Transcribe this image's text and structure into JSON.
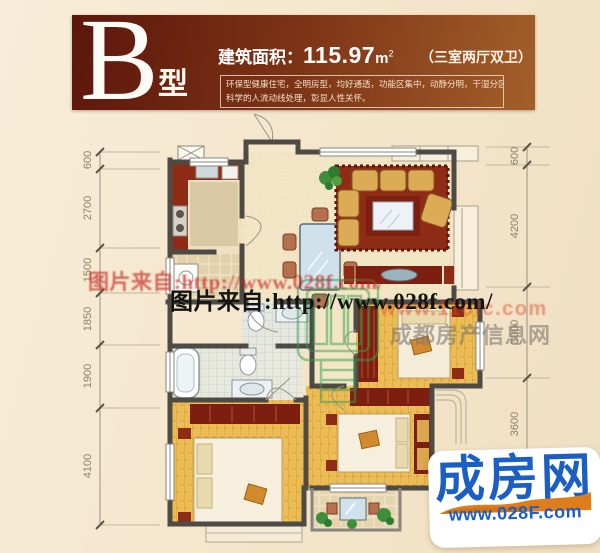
{
  "page": {
    "background": "#f4e6cf"
  },
  "header": {
    "type_letter": "B",
    "type_suffix": "型",
    "area_label": "建筑面积：",
    "area_value": "115.97",
    "area_unit": "m",
    "area_sup": "2",
    "layout_label": "（三室两厅双卫）",
    "desc_line1": "环保型健康住宅，全明房型，均好通透，功能区集中，动静分明，干湿分区，",
    "desc_line2": "科学的人流动线处理，彰显人性关怀。",
    "colors": {
      "gradient_left": "#5c160b",
      "gradient_right": "#a35f2a"
    }
  },
  "floor_plan": {
    "dims_left": [
      "600",
      "2700",
      "1500",
      "1850",
      "1900",
      "4100"
    ],
    "dims_right": [
      "600",
      "4200",
      "3000",
      "3600"
    ],
    "colors": {
      "wall": "#4e4a44",
      "wood_floor": "#edbd55",
      "rug": "#8e2c15",
      "cabinet": "#7c1f10",
      "sofa": "#dcab55"
    }
  },
  "watermarks": {
    "photo_red": "图片来自:http://www.028f.com/",
    "photo_black": "图片来自:http://www.028f.com/",
    "site_red": "www.118fc.com",
    "site_gray": "成都房产信息网"
  },
  "logo": {
    "name": "成房网",
    "url": "www.028F.com",
    "colors": {
      "text": "#1b5ec4",
      "swoosh": "#df7d1a"
    }
  }
}
